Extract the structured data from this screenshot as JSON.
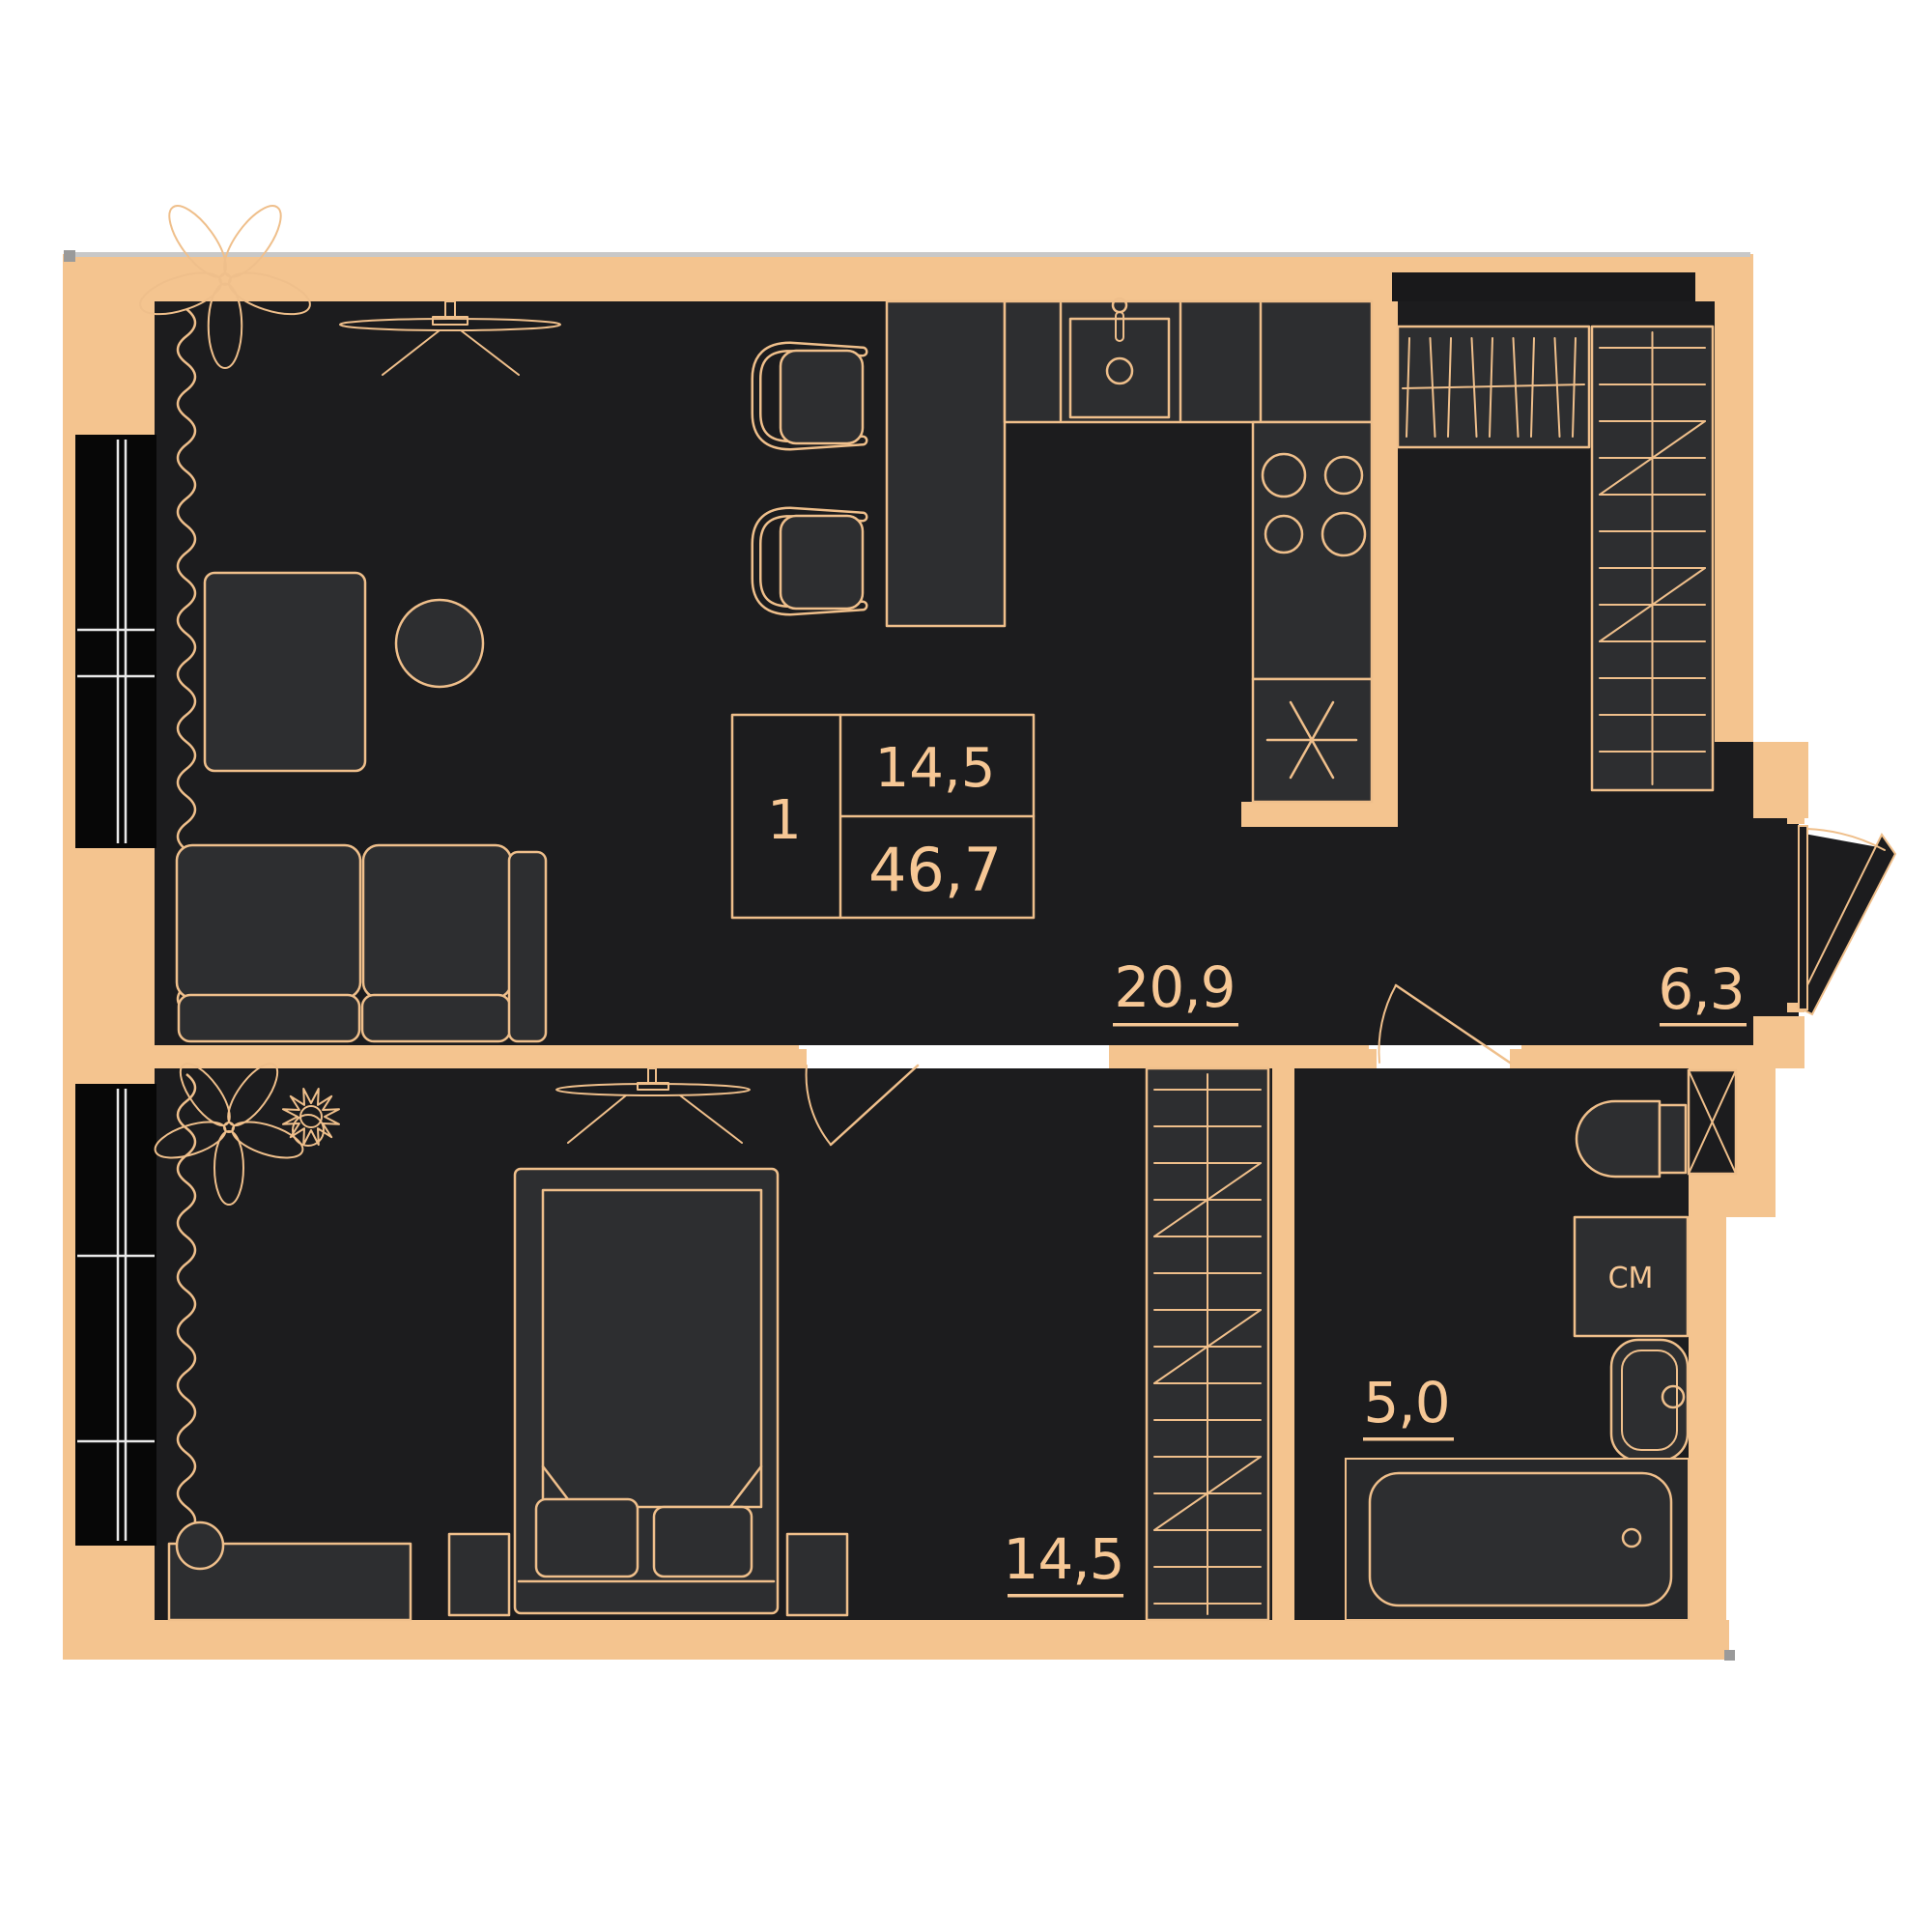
{
  "title": "1-room apartment floor plan",
  "theme": {
    "background": "#ffffff",
    "wall": "#f4c48f",
    "floor": "#1c1c1e",
    "furniture": "#2d2e30",
    "line": "#efbf8b",
    "text": "#f6c795",
    "window": "#070707",
    "shadow": "#c8c8c8",
    "niche": "#19191b",
    "tub_zone": "#27282a"
  },
  "info_box": {
    "rooms_count": "1",
    "living_area": "14,5",
    "total_area": "46,7"
  },
  "rooms": {
    "living_kitchen": {
      "name": "living-kitchen",
      "area_label": "20,9"
    },
    "hallway": {
      "name": "hallway",
      "area_label": "6,3"
    },
    "bedroom": {
      "name": "bedroom",
      "area_label": "14,5"
    },
    "bathroom": {
      "name": "bathroom",
      "area_label": "5,0"
    }
  },
  "appliances": {
    "washing_machine_label": "СМ"
  }
}
